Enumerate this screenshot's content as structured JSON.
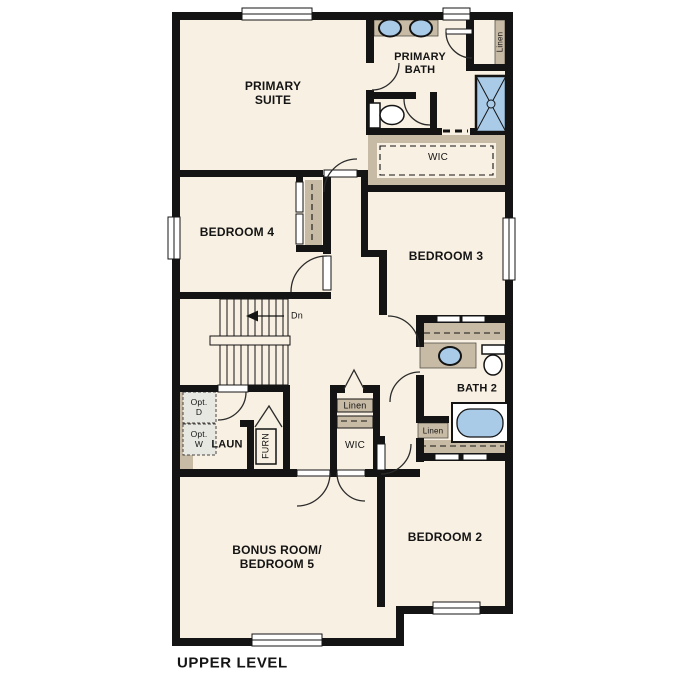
{
  "title": "UPPER LEVEL",
  "rooms": {
    "primary_suite": "PRIMARY\nSUITE",
    "primary_bath": "PRIMARY\nBATH",
    "primary_wic": "WIC",
    "linen_top": "Linen",
    "bedroom4": "BEDROOM 4",
    "bedroom3": "BEDROOM 3",
    "stairs_down": "Dn",
    "laundry": "LAUN",
    "furnace": "FURN",
    "opt_dryer": "Opt.\nD",
    "opt_washer": "Opt.\nW",
    "linen_mid": "Linen",
    "wic_mid": "WIC",
    "bath2": "BATH 2",
    "linen_bath2": "Linen",
    "bedroom2": "BEDROOM 2",
    "bonus_room": "BONUS ROOM/\nBEDROOM 5"
  },
  "colors": {
    "floor": "#f8f0e2",
    "wall": "#141414",
    "counter": "#c8bba5",
    "fixture": "#a9cbe8",
    "optbox": "#e8e8e3"
  }
}
